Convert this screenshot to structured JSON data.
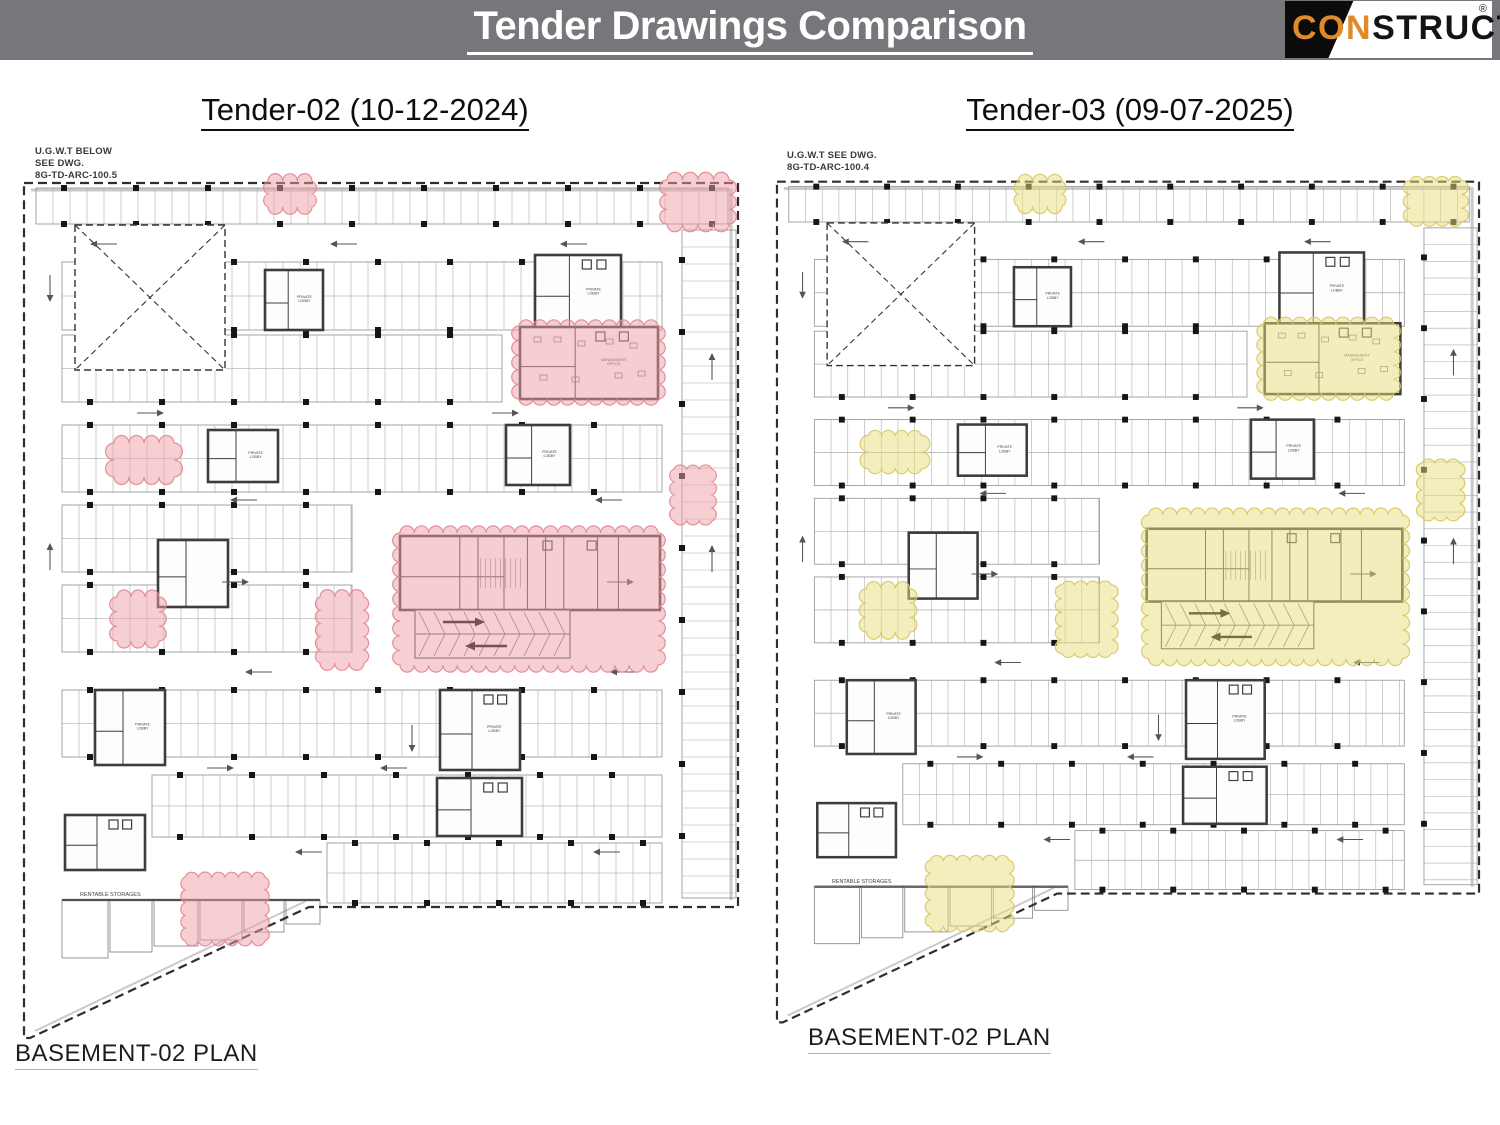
{
  "header": {
    "title": "Tender Drawings Comparison",
    "bar_color": "#76777b",
    "logo": {
      "left": "CON",
      "right": "STRUCT",
      "registered": "®",
      "orange": "#e08a28",
      "black": "#0b0b0b"
    }
  },
  "panels": [
    {
      "id": "tender-02",
      "subtitle": "Tender-02 (10-12-2024)",
      "note_lines": [
        "U.G.W.T BELOW",
        "SEE DWG.",
        "8G-TD-ARC-100.5"
      ],
      "plan_label": "BASEMENT-02 PLAN",
      "highlight": {
        "fill": "#ef9ea6",
        "stroke": "#e2858f"
      },
      "highlights": [
        {
          "x": 246,
          "y": 1,
          "w": 44,
          "h": 26
        },
        {
          "x": 645,
          "y": 0,
          "w": 62,
          "h": 44
        },
        {
          "x": 497,
          "y": 146,
          "w": 139,
          "h": 73
        },
        {
          "x": 92,
          "y": 263,
          "w": 60,
          "h": 34
        },
        {
          "x": 652,
          "y": 289,
          "w": 38,
          "h": 52
        },
        {
          "x": 378,
          "y": 353,
          "w": 258,
          "h": 132
        },
        {
          "x": 298,
          "y": 417,
          "w": 44,
          "h": 66
        },
        {
          "x": 95,
          "y": 417,
          "w": 42,
          "h": 44
        },
        {
          "x": 163,
          "y": 697,
          "w": 80,
          "h": 64
        }
      ]
    },
    {
      "id": "tender-03",
      "subtitle": "Tender-03 (09-07-2025)",
      "note_lines": [
        "U.G.W.T SEE DWG.",
        "8G-TD-ARC-100.4"
      ],
      "plan_label": "BASEMENT-02 PLAN",
      "highlight": {
        "fill": "#e9dd7e",
        "stroke": "#d6c75f"
      },
      "highlights": [
        {
          "x": 247,
          "y": 3,
          "w": 45,
          "h": 25
        },
        {
          "x": 646,
          "y": 2,
          "w": 52,
          "h": 42
        },
        {
          "x": 497,
          "y": 148,
          "w": 132,
          "h": 70
        },
        {
          "x": 95,
          "y": 261,
          "w": 54,
          "h": 34
        },
        {
          "x": 658,
          "y": 289,
          "w": 38,
          "h": 55
        },
        {
          "x": 380,
          "y": 342,
          "w": 258,
          "h": 146
        },
        {
          "x": 292,
          "y": 413,
          "w": 50,
          "h": 70
        },
        {
          "x": 93,
          "y": 417,
          "w": 44,
          "h": 44
        },
        {
          "x": 158,
          "y": 693,
          "w": 80,
          "h": 68
        }
      ]
    }
  ],
  "plan": {
    "boundary": "M 2 3 H 716 V 727 H 287 L 8 858 H 2 Z",
    "inner_border": "M 9 10 H 709 V 720",
    "inner_diagonal": "M 284 721 L 13 851",
    "bands": [
      {
        "x": 14,
        "y": 8,
        "w": 692,
        "h": 36
      },
      {
        "x": 40,
        "y": 82,
        "w": 600,
        "h": 68
      },
      {
        "x": 40,
        "y": 155,
        "w": 440,
        "h": 67
      },
      {
        "x": 40,
        "y": 245,
        "w": 600,
        "h": 67
      },
      {
        "x": 40,
        "y": 325,
        "w": 290,
        "h": 67
      },
      {
        "x": 40,
        "y": 405,
        "w": 290,
        "h": 67
      },
      {
        "x": 40,
        "y": 510,
        "w": 600,
        "h": 67
      },
      {
        "x": 130,
        "y": 595,
        "w": 510,
        "h": 62
      },
      {
        "x": 305,
        "y": 663,
        "w": 335,
        "h": 60
      }
    ],
    "right_column": {
      "x": 660,
      "y": 50,
      "w": 54,
      "h": 668
    },
    "xbox": {
      "x": 53,
      "y": 45,
      "w": 150,
      "h": 145
    },
    "cores": [
      {
        "x": 243,
        "y": 90,
        "w": 58,
        "h": 60,
        "label": "PRIVATE LOBBY"
      },
      {
        "x": 513,
        "y": 75,
        "w": 86,
        "h": 75,
        "label": "PRIVATE LOBBY"
      },
      {
        "x": 498,
        "y": 147,
        "w": 138,
        "h": 72,
        "label": "MANAGEMENT OFFICE",
        "office": true
      },
      {
        "x": 186,
        "y": 250,
        "w": 70,
        "h": 52,
        "label": "PRIVATE LOBBY"
      },
      {
        "x": 484,
        "y": 245,
        "w": 64,
        "h": 60,
        "label": "PRIVATE LOBBY"
      },
      {
        "x": 378,
        "y": 356,
        "w": 260,
        "h": 74,
        "label": "",
        "central": true
      },
      {
        "x": 136,
        "y": 360,
        "w": 70,
        "h": 67,
        "label": ""
      },
      {
        "x": 73,
        "y": 510,
        "w": 70,
        "h": 75,
        "label": "PRIVATE LOBBY"
      },
      {
        "x": 418,
        "y": 510,
        "w": 80,
        "h": 80,
        "label": "PRIVATE LOBBY"
      },
      {
        "x": 415,
        "y": 598,
        "w": 85,
        "h": 58,
        "label": ""
      },
      {
        "x": 43,
        "y": 635,
        "w": 80,
        "h": 55,
        "label": ""
      }
    ],
    "ramp": {
      "x": 393,
      "y": 430,
      "w": 155,
      "h": 48
    },
    "storages": {
      "label": "RENTABLE STORAGES",
      "label_x": 58,
      "label_y": 716,
      "rooms": [
        [
          40,
          720,
          46,
          58
        ],
        [
          88,
          720,
          42,
          52
        ],
        [
          132,
          720,
          44,
          46
        ],
        [
          178,
          720,
          42,
          40
        ],
        [
          222,
          720,
          40,
          32
        ],
        [
          264,
          720,
          34,
          24
        ]
      ]
    },
    "arrows": [
      {
        "x": 95,
        "y": 64,
        "d": "l"
      },
      {
        "x": 335,
        "y": 64,
        "d": "l"
      },
      {
        "x": 565,
        "y": 64,
        "d": "l"
      },
      {
        "x": 115,
        "y": 233,
        "d": "r"
      },
      {
        "x": 470,
        "y": 233,
        "d": "r"
      },
      {
        "x": 235,
        "y": 320,
        "d": "l"
      },
      {
        "x": 600,
        "y": 320,
        "d": "l"
      },
      {
        "x": 200,
        "y": 402,
        "d": "r"
      },
      {
        "x": 585,
        "y": 402,
        "d": "r"
      },
      {
        "x": 250,
        "y": 492,
        "d": "l"
      },
      {
        "x": 615,
        "y": 492,
        "d": "l"
      },
      {
        "x": 185,
        "y": 588,
        "d": "r"
      },
      {
        "x": 385,
        "y": 588,
        "d": "l"
      },
      {
        "x": 300,
        "y": 672,
        "d": "l"
      },
      {
        "x": 598,
        "y": 672,
        "d": "l"
      },
      {
        "x": 28,
        "y": 95,
        "d": "dn"
      },
      {
        "x": 28,
        "y": 390,
        "d": "up"
      },
      {
        "x": 690,
        "y": 392,
        "d": "up"
      },
      {
        "x": 390,
        "y": 545,
        "d": "dn"
      },
      {
        "x": 690,
        "y": 200,
        "d": "up"
      }
    ]
  }
}
